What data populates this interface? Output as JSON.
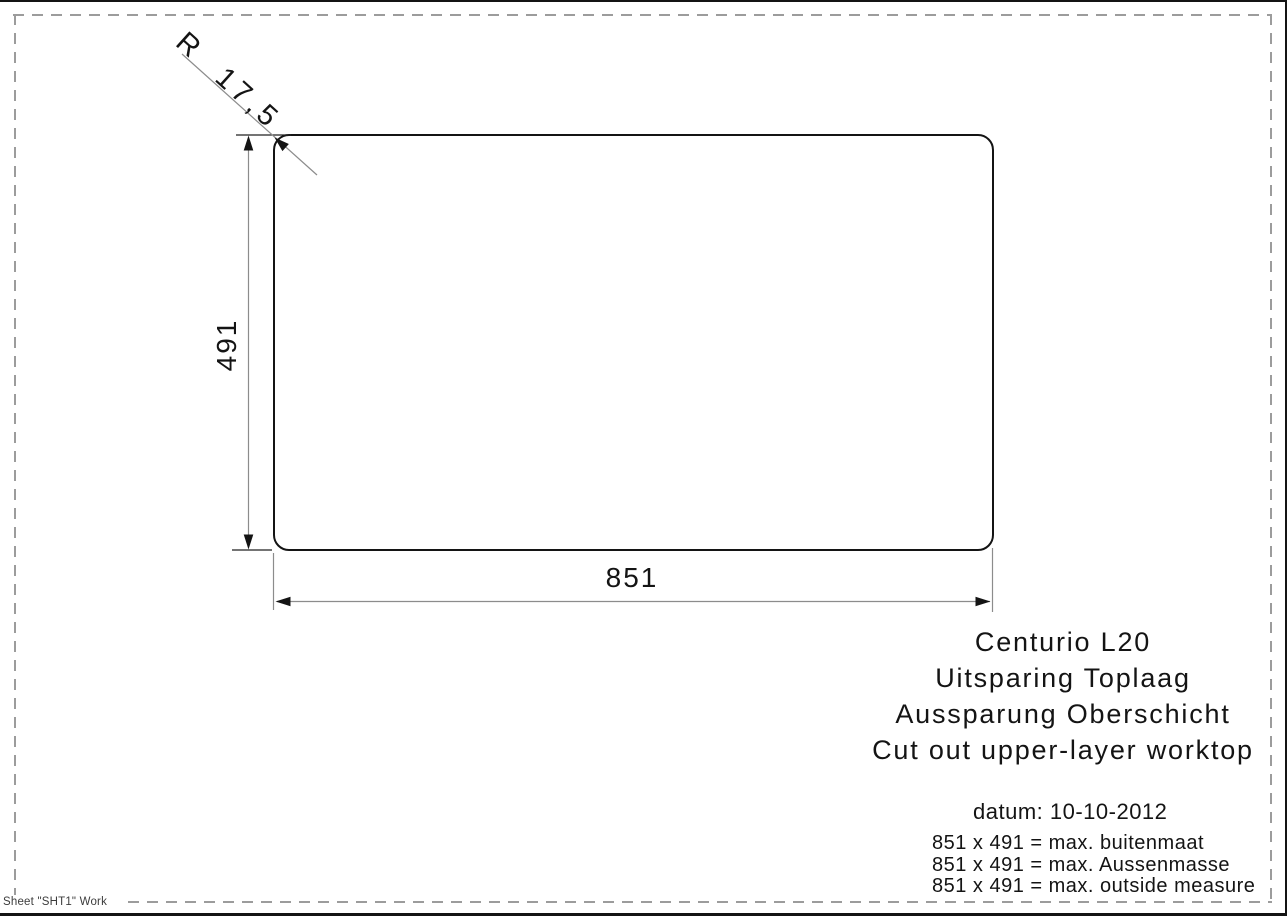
{
  "drawing": {
    "radius_label": "R 17,5",
    "height_dim": "491",
    "width_dim": "851",
    "line_color": "#141414",
    "dim_line_color": "#8c8c8c",
    "frame_dash_color": "#9c9c9c",
    "corner_radius_px": 15
  },
  "title_block": {
    "lines": [
      "Centurio L20",
      "Uitsparing Toplaag",
      "Aussparung Oberschicht",
      "Cut out upper-layer worktop"
    ]
  },
  "date_line": "datum: 10-10-2012",
  "notes": [
    "851 x 491 = max. buitenmaat",
    "851 x 491 = max. Aussenmasse",
    "851 x 491 = max. outside measure"
  ],
  "footer": "Sheet \"SHT1\" Work"
}
